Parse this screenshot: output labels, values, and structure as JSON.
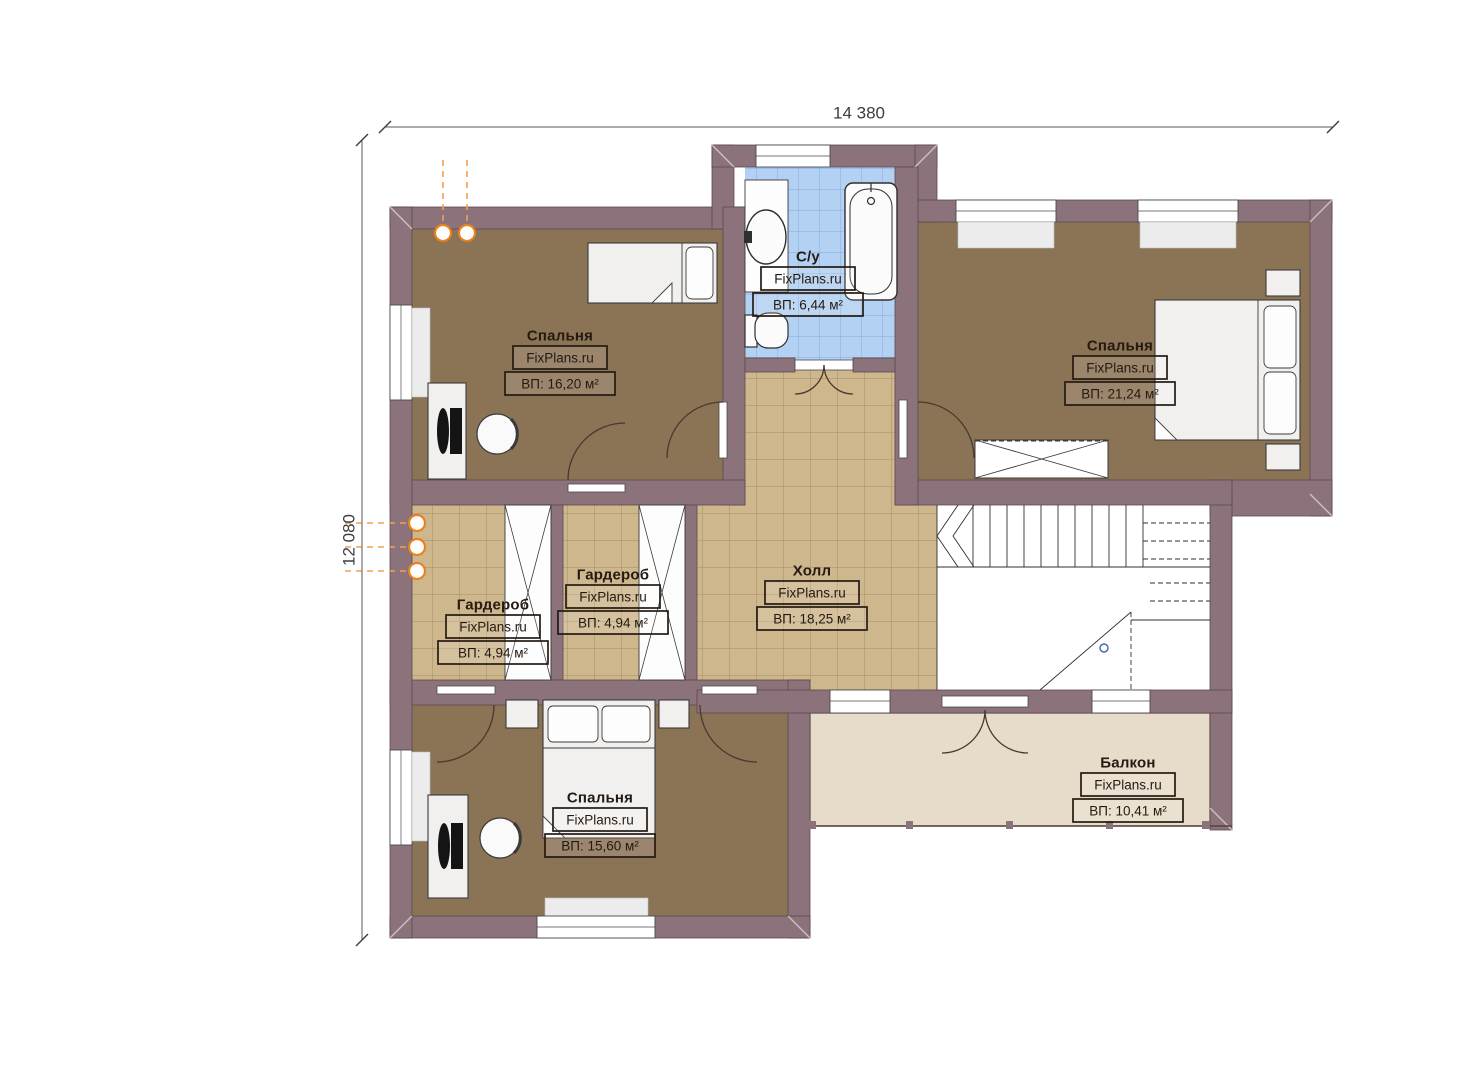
{
  "dimensions": {
    "width_label": "14 380",
    "height_label": "12 080"
  },
  "rooms": {
    "bedroom_top_left": {
      "name": "Спальня",
      "watermark": "FixPlans.ru",
      "area": "ВП: 16,20 м²"
    },
    "bathroom": {
      "name": "С/у",
      "watermark": "FixPlans.ru",
      "area": "ВП: 6,44 м²"
    },
    "bedroom_top_right": {
      "name": "Спальня",
      "watermark": "FixPlans.ru",
      "area": "ВП: 21,24 м²"
    },
    "wardrobe_left": {
      "name": "Гардероб",
      "watermark": "FixPlans.ru",
      "area": "ВП: 4,94 м²"
    },
    "wardrobe_middle": {
      "name": "Гардероб",
      "watermark": "FixPlans.ru",
      "area": "ВП: 4,94 м²"
    },
    "hall": {
      "name": "Холл",
      "watermark": "FixPlans.ru",
      "area": "ВП: 18,25 м²"
    },
    "bedroom_bottom_left": {
      "name": "Спальня",
      "watermark": "FixPlans.ru",
      "area": "ВП: 15,60 м²"
    },
    "balcony": {
      "name": "Балкон",
      "watermark": "FixPlans.ru",
      "area": "ВП: 10,41 м²"
    }
  },
  "colors": {
    "wall": "#8c737b",
    "bedroom_floor": "#8b7355",
    "tile_floor": "#cfb78d",
    "tile_grout": "#a68e63",
    "bathroom_tile": "#b3d1f2",
    "bathroom_grout": "#85abdc",
    "balcony_floor": "#e7dcc9",
    "radiator": "#e8821e"
  }
}
